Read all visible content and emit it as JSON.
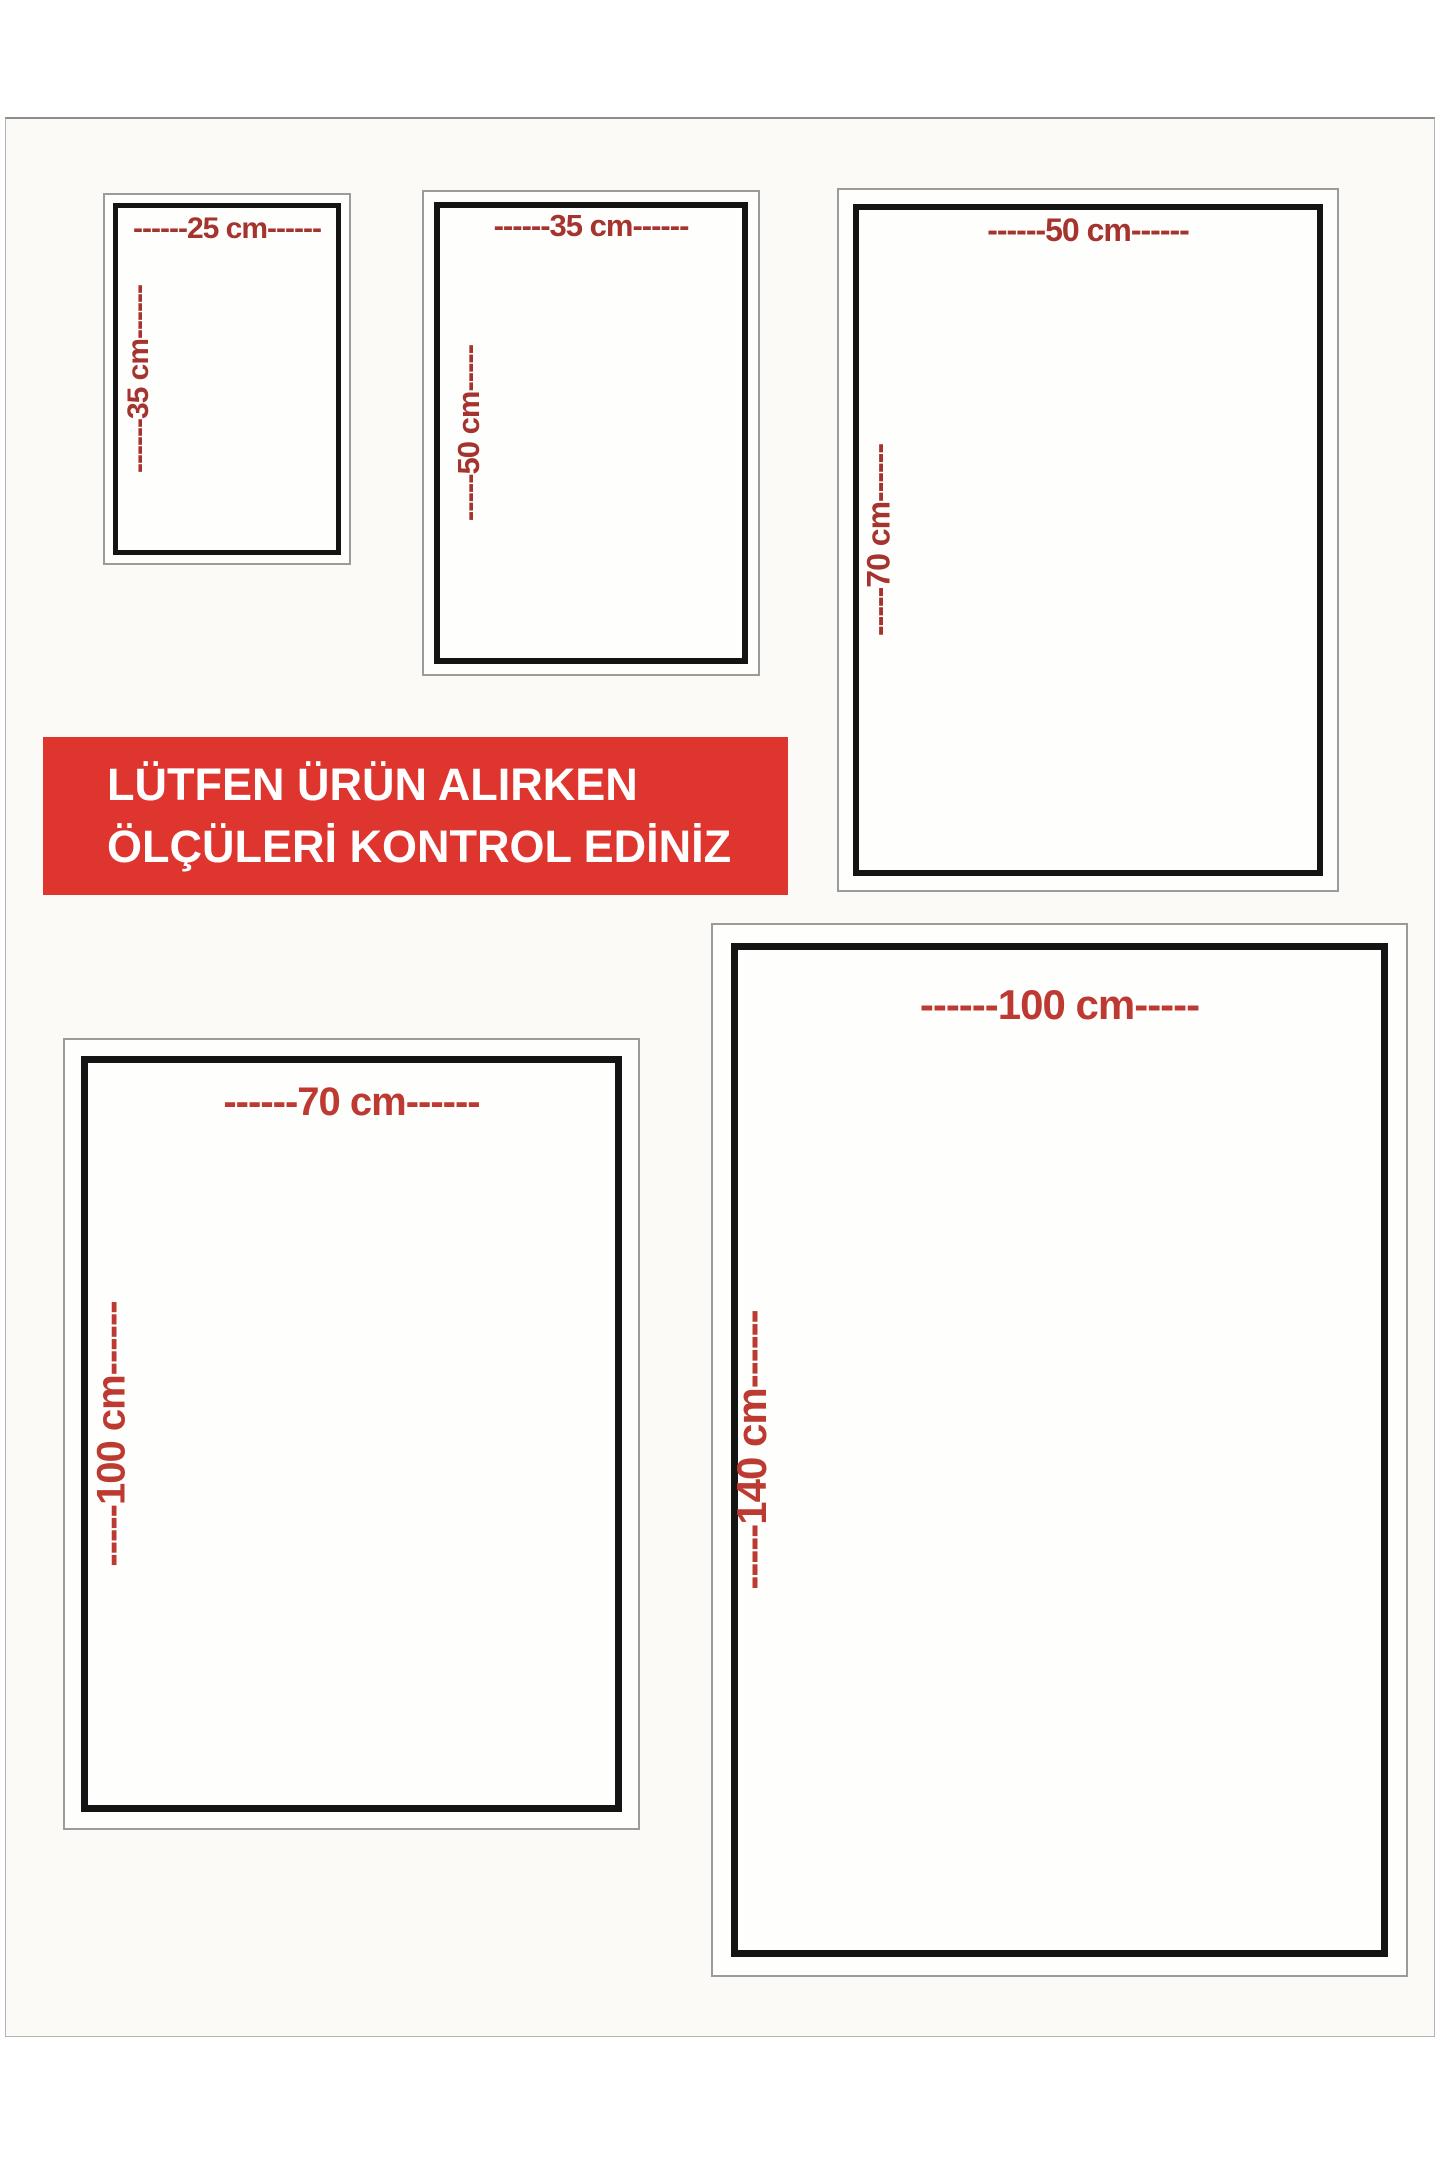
{
  "banner": {
    "line1": "LÜTFEN ÜRÜN ALIRKEN",
    "line2": "ÖLÇÜLERİ KONTROL EDİNİZ",
    "bg_color": "#df352f",
    "text_color": "#ffffff"
  },
  "boxes": [
    {
      "name": "25x35",
      "width_cm": 25,
      "height_cm": 35,
      "width_label": "------25 cm------",
      "height_label": "------35 cm------"
    },
    {
      "name": "35x50",
      "width_cm": 35,
      "height_cm": 50,
      "width_label": "------35 cm------",
      "height_label": "-----50 cm-----"
    },
    {
      "name": "50x70",
      "width_cm": 50,
      "height_cm": 70,
      "width_label": "------50 cm------",
      "height_label": "-----70 cm------"
    },
    {
      "name": "70x100",
      "width_cm": 70,
      "height_cm": 100,
      "width_label": "------70 cm------",
      "height_label": "-----100 cm------"
    },
    {
      "name": "100x140",
      "width_cm": 100,
      "height_cm": 140,
      "width_label": "------100 cm-----",
      "height_label": "-----140 cm------"
    }
  ],
  "colors": {
    "dimension_label_small": "#a5332e",
    "dimension_label_large": "#bd3a32",
    "inner_frame": "#141414",
    "outer_frame": "#9b9b99",
    "sheet_background": "#fbfaf7",
    "banner_background": "#df352f"
  }
}
